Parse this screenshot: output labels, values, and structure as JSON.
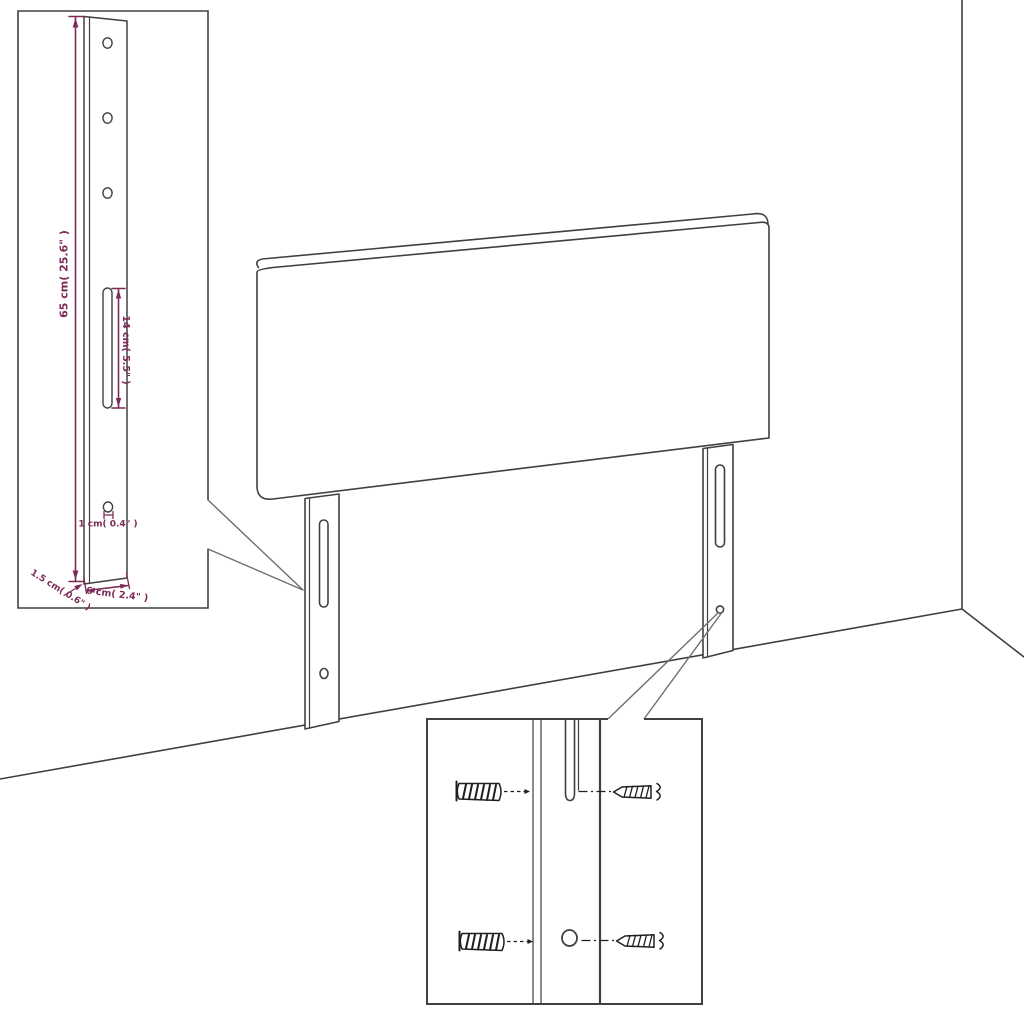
{
  "page": {
    "background": "#ffffff"
  },
  "colors": {
    "line": "#404040",
    "dimension": "#7c2a58",
    "hardware": "#1f1f1f"
  },
  "inset_detail": {
    "height_label": "65 cm( 25.6\" )",
    "slot_label": "14 cm( 5.5\" )",
    "hole_label": "1 cm( 0.4\" )",
    "thickness_label": "1.5 cm( 0.6\" )",
    "width_label": "6 cm( 2.4\" )"
  },
  "icons": {
    "inset_figure": "headboard-leg-bracket",
    "main_figure": "headboard-panel-with-legs",
    "detail_figure": "mounting-hardware-closeup",
    "hardware": [
      "wall-plug-icon",
      "screw-icon",
      "wall-plug-icon",
      "screw-icon"
    ]
  }
}
